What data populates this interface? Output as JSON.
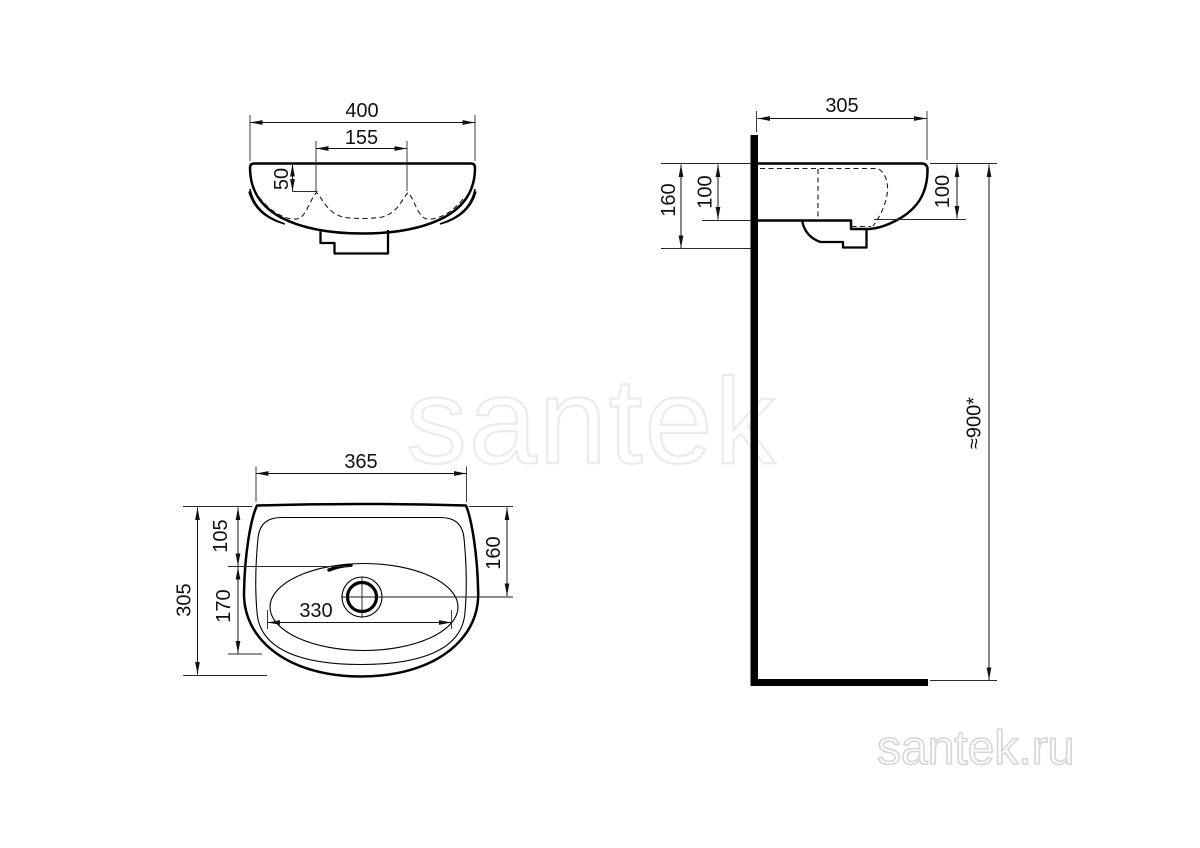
{
  "colors": {
    "line": "#000000",
    "dim_line": "#111111",
    "watermark": "#ebebeb",
    "logo": "#d6d6d6"
  },
  "watermark": {
    "text": "santek"
  },
  "logo": {
    "text": "santek.ru"
  },
  "front_view": {
    "dims": {
      "overall_width": "400",
      "tap_hole_spacing": "155",
      "rim_drop": "50"
    }
  },
  "side_view": {
    "dims": {
      "depth": "305",
      "overall_height": "160",
      "bowl_depth_left": "100",
      "bowl_depth_right": "100",
      "mounting_height": "≈900*"
    }
  },
  "plan_view": {
    "dims": {
      "top_width": "365",
      "overall_depth": "305",
      "rim_to_tap_line": "105",
      "tap_line_to_bowl": "170",
      "bowl_width": "330",
      "rim_to_drain": "160"
    }
  }
}
